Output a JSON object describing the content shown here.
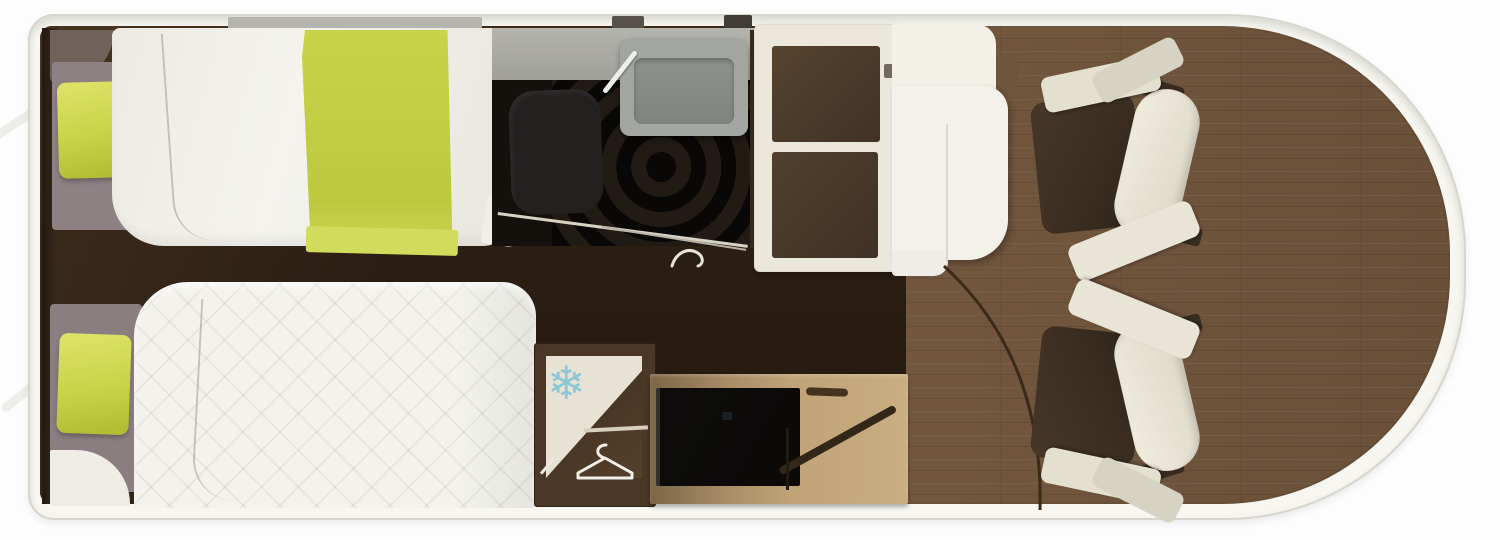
{
  "meta": {
    "kind": "motorhome-floor-plan-render",
    "canvas_width": 1500,
    "canvas_height": 540
  },
  "colors": {
    "page_bg": "#fdfdfd",
    "shell": "#f7f6f1",
    "shell_outline": "#d8d5cc",
    "floor_dark": "#2e2116",
    "floor_wood": "#6e543d",
    "wall_gray": "#aaa9a3",
    "duvet_white": "#f2f1ea",
    "quilt_white": "#f3f2ec",
    "lime": "#c8d348",
    "lime_light": "#dce266",
    "mauve_pad": "#8d8184",
    "headboard_dark": "#32251a",
    "shower_black": "#14100c",
    "toilet_gray": "#232120",
    "sink_gray": "#a3a6a0",
    "cream_unit": "#ebe8db",
    "white_unit": "#f3f1e9",
    "bench_brown": "#4c3a2a",
    "cabinet_frame": "#4a3725",
    "cabinet_tan": "#c0a377",
    "tv_black": "#0b0a09",
    "snowflake_blue": "#8cc7d8",
    "hanger_white": "#f2efe6",
    "chair_cream": "#e9e5d6",
    "chair_brown": "#3a2d20",
    "arc_brown": "#3a2a18"
  },
  "icons": {
    "freezer_glyph": "❄",
    "freezer_icon_name": "snowflake-icon",
    "wardrobe_icon_name": "hanger-icon"
  },
  "furniture": {
    "bedroom": [
      "single-bed-top",
      "single-bed-bottom",
      "lime-pillow-top",
      "lime-pillow-bottom",
      "lime-runner"
    ],
    "bathroom": [
      "shower-tray",
      "toilet",
      "washbasin",
      "folding-door"
    ],
    "dinette": [
      "bench-seat-upper",
      "bench-seat-lower",
      "side-unit"
    ],
    "storage": [
      "fridge-freezer",
      "wardrobe",
      "tv-sideboard",
      "flatscreen-tv"
    ],
    "cab": [
      "swivel-seat-upper",
      "swivel-seat-lower",
      "entry-door-swing"
    ]
  }
}
